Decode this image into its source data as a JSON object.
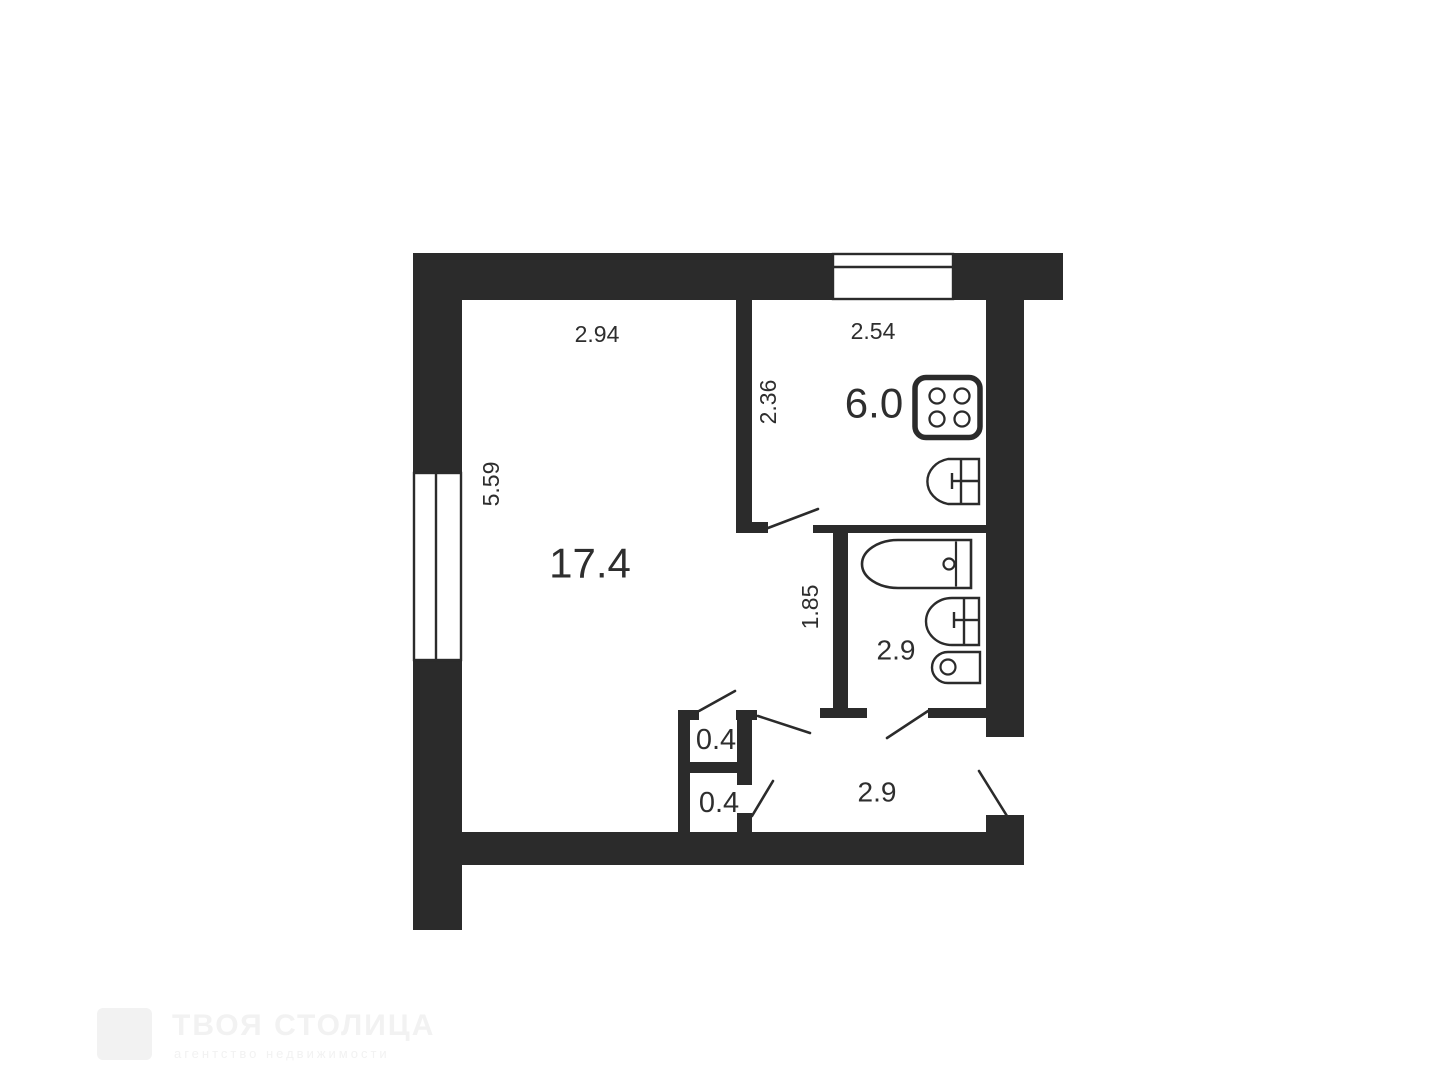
{
  "title": "Apartment floor plan",
  "colors": {
    "wall": "#2b2b2b",
    "line": "#2b2b2b",
    "text": "#2e2e2e",
    "watermark": "#f2f2f2",
    "background": "#ffffff"
  },
  "rooms": {
    "living": {
      "area": "17.4",
      "dim_width": "2.94",
      "dim_height": "5.59"
    },
    "kitchen": {
      "area": "6.0",
      "dim_width": "2.54",
      "dim_height": "2.36"
    },
    "bathroom": {
      "area": "2.9",
      "dim_height": "1.85"
    },
    "hallway": {
      "area": "2.9"
    },
    "closet_upper": {
      "area": "0.4"
    },
    "closet_lower": {
      "area": "0.4"
    }
  },
  "fixtures": {
    "stove": "stove",
    "kitchen_sink": "kitchen-sink",
    "bathtub": "bathtub",
    "bathroom_sink": "bathroom-sink",
    "toilet": "toilet"
  },
  "watermark": {
    "title": "ТВОЯ СТОЛИЦА",
    "subtitle": "агентство недвижимости"
  }
}
